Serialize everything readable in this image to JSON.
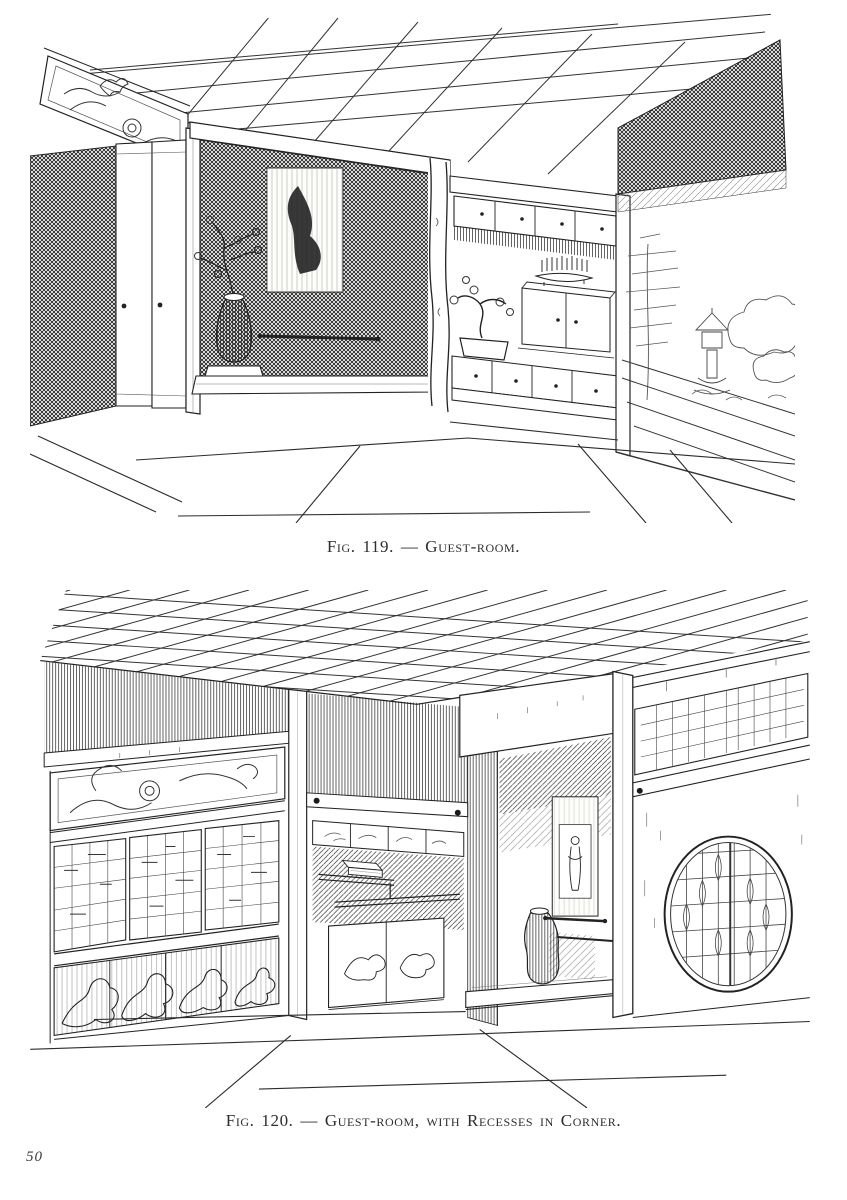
{
  "page": {
    "number": "50"
  },
  "colors": {
    "paper": "#ffffff",
    "ink": "#222222"
  },
  "figures": [
    {
      "id": "fig-119",
      "caption": "Fig. 119. — Guest-room.",
      "alt": "Line engraving, perspective view of a Japanese guest-room: tokonoma alcove with dark hanging scroll and vase with branch, staggered shelves with cupboards, bonsai and tray, sliding screens and dark doorway at left, garden with tree, bushes and stone lantern at right, tatami floor."
    },
    {
      "id": "fig-120",
      "caption": "Fig. 120. — Guest-room, with Recesses in Corner.",
      "alt": "Line engraving, perspective view of a guest-room with corner recesses: carved wave transom over latticed shoji and painted panels at left, shelved recess with small painted cupboards, tokonoma with hanging scroll and vase, round latticed window at right, square grid ceiling, tatami floor."
    }
  ]
}
